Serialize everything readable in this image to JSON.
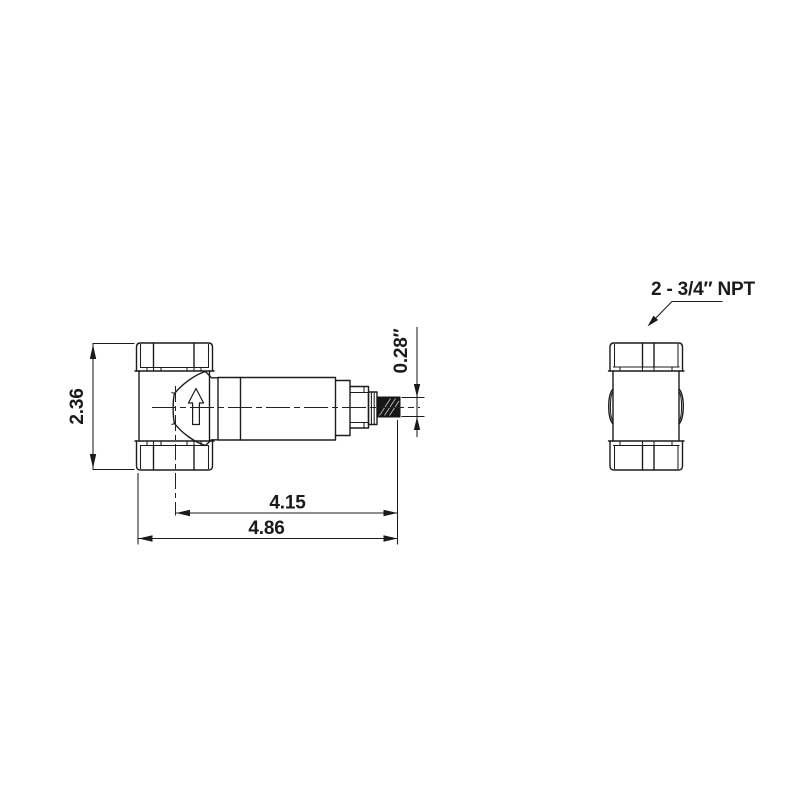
{
  "drawing": {
    "kind": "technical-dimension-drawing",
    "subject": "inline flow sensor / valve, front view and end view",
    "units": "inches",
    "background_color": "#ffffff",
    "line_color": "#1c1c1c",
    "text_color": "#1a1a1a"
  },
  "dimensions": {
    "height": "2.36",
    "length_to_port_center": "4.15",
    "overall_length": "4.86",
    "stub_diameter": "0.28″"
  },
  "labels": {
    "ports": "2 - 3/4″ NPT"
  }
}
